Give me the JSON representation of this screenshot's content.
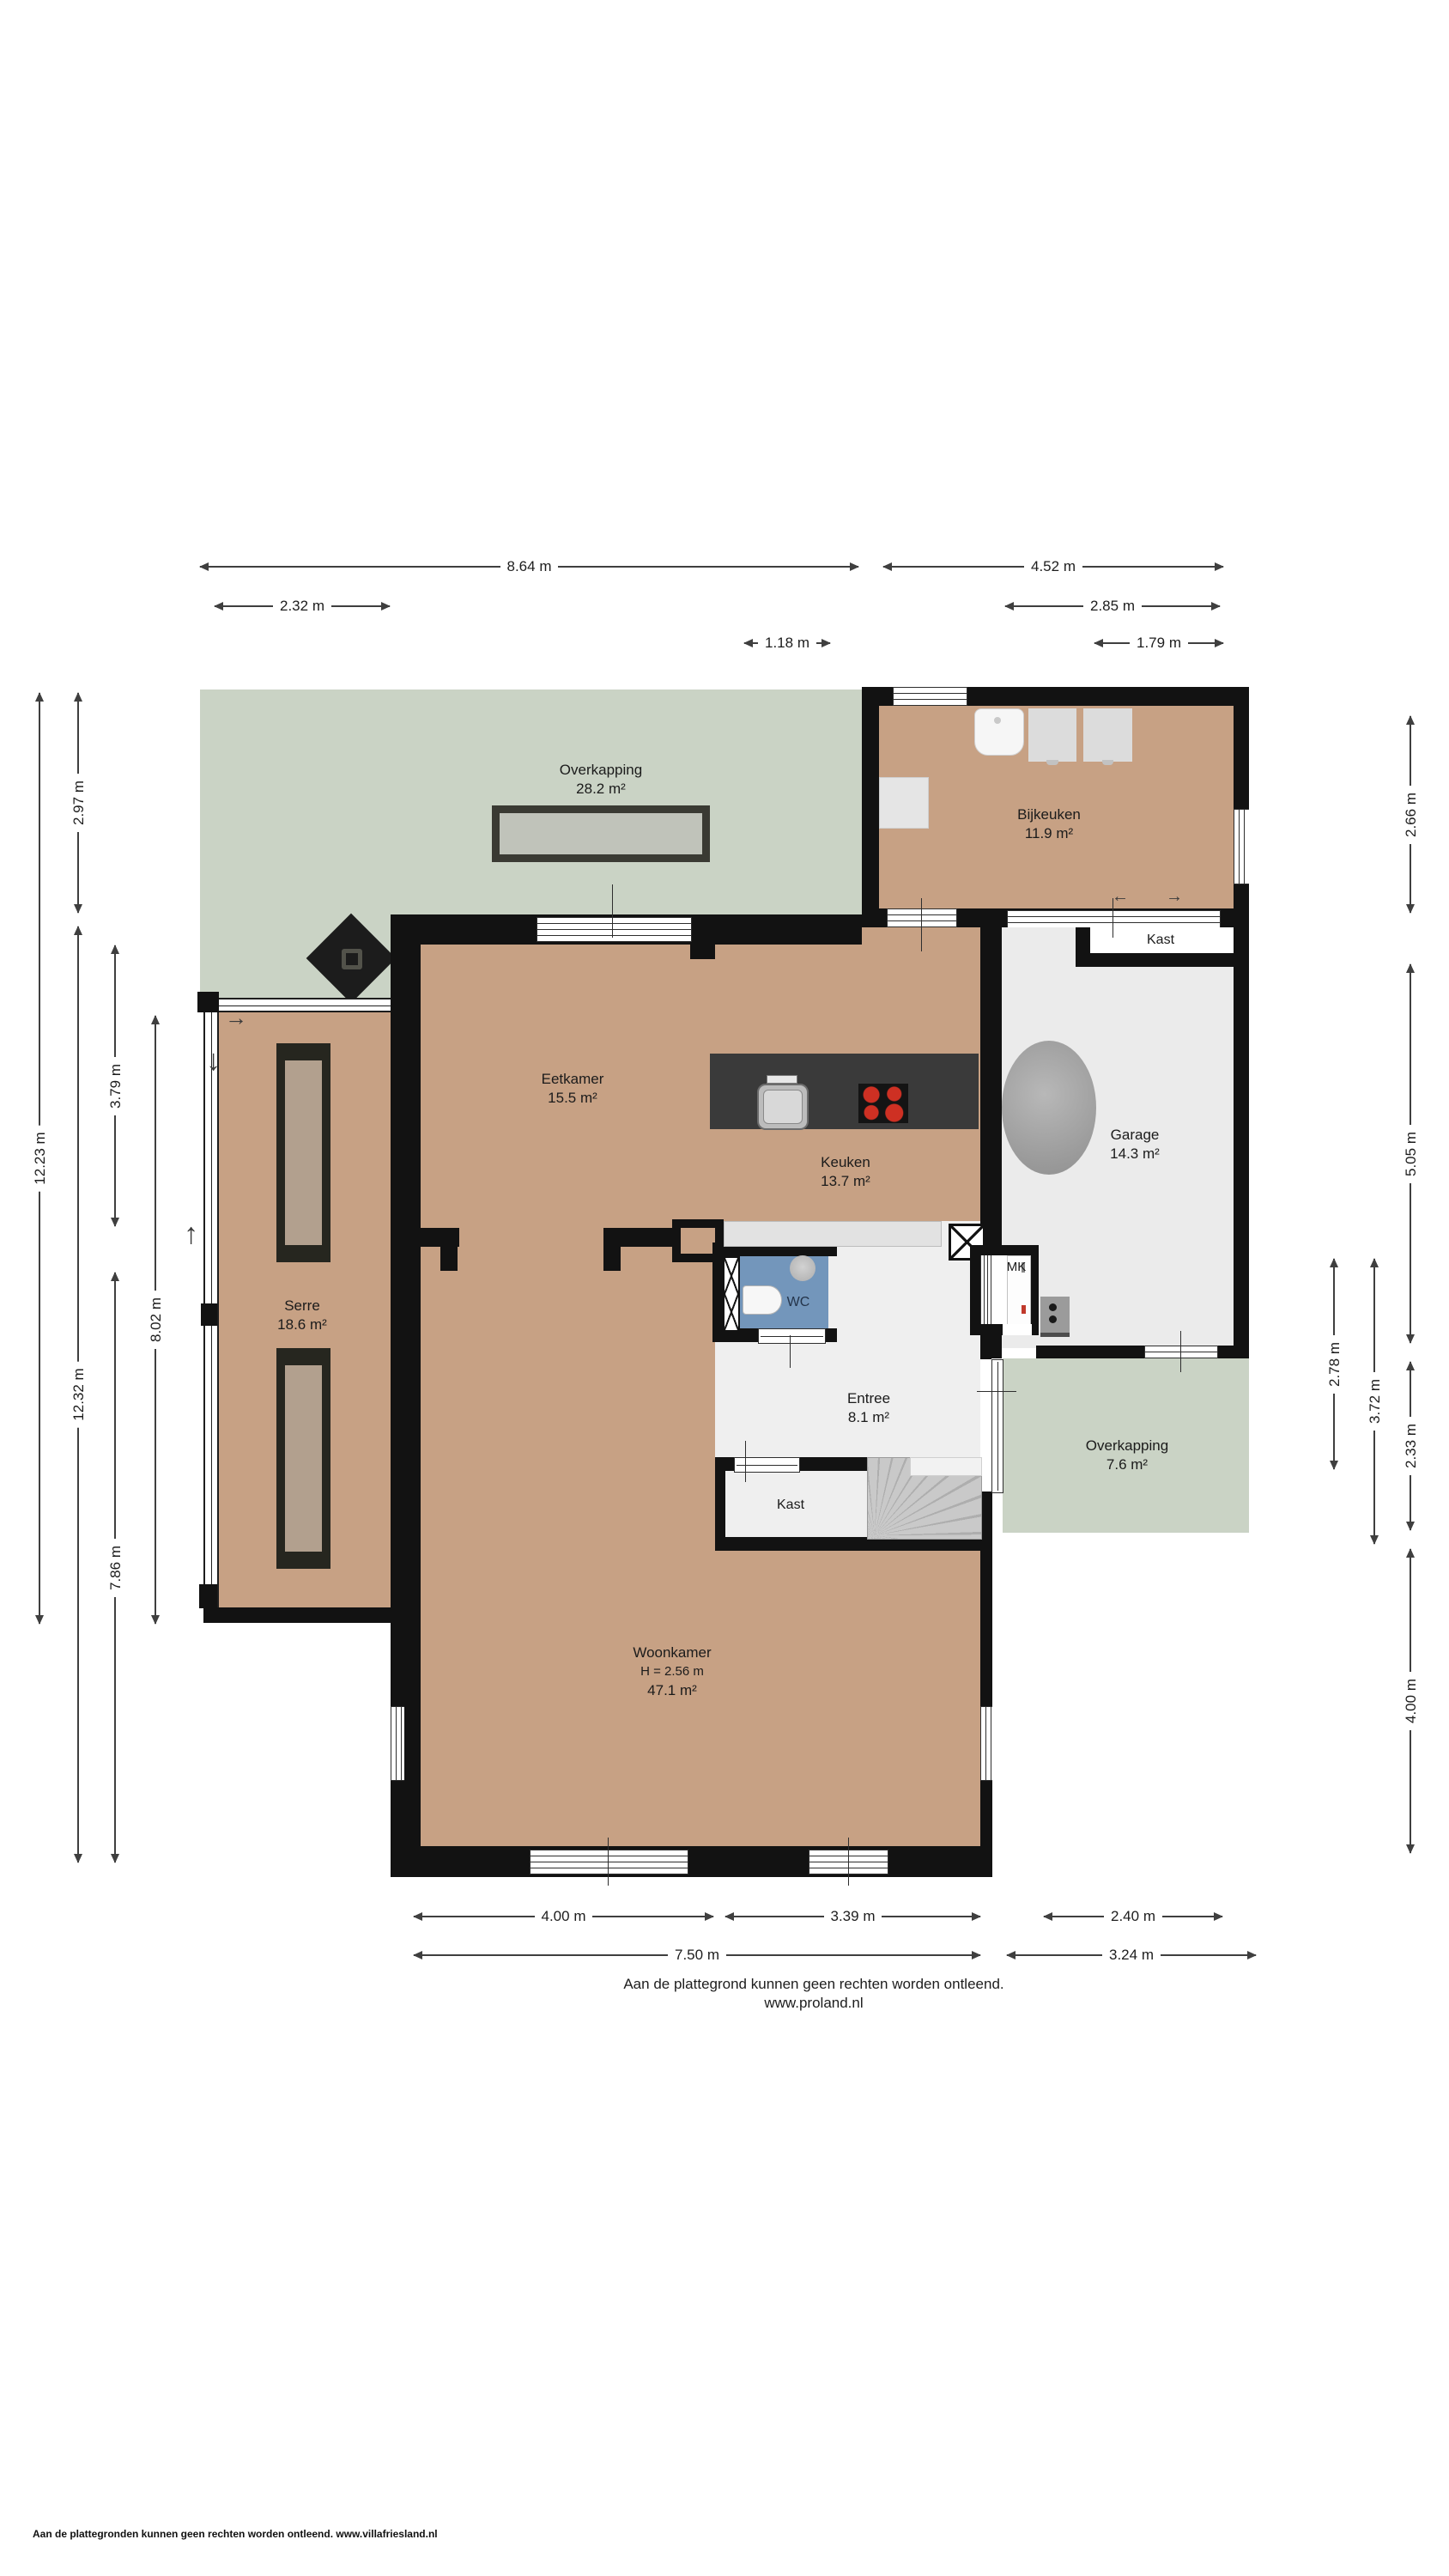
{
  "rooms": {
    "overkapping_top": {
      "name": "Overkapping",
      "area": "28.2 m²"
    },
    "bijkeuken": {
      "name": "Bijkeuken",
      "area": "11.9 m²"
    },
    "kast_top": {
      "name": "Kast"
    },
    "garage": {
      "name": "Garage",
      "area": "14.3 m²"
    },
    "eetkamer": {
      "name": "Eetkamer",
      "area": "15.5 m²"
    },
    "keuken": {
      "name": "Keuken",
      "area": "13.7 m²"
    },
    "serre": {
      "name": "Serre",
      "area": "18.6 m²"
    },
    "wc": {
      "name": "WC"
    },
    "mk": {
      "name": "MK"
    },
    "entree": {
      "name": "Entree",
      "area": "8.1 m²"
    },
    "kast_bottom": {
      "name": "Kast"
    },
    "woonkamer": {
      "name": "Woonkamer",
      "ceiling_height": "H = 2.56 m",
      "area": "47.1 m²"
    },
    "overkapping_right": {
      "name": "Overkapping",
      "area": "7.6 m²"
    }
  },
  "dimensions": {
    "top": [
      {
        "label": "8.64 m"
      },
      {
        "label": "4.52 m"
      },
      {
        "label": "2.32 m"
      },
      {
        "label": "2.85 m"
      },
      {
        "label": "1.18 m"
      },
      {
        "label": "1.79 m"
      }
    ],
    "left": [
      {
        "label": "12.23 m"
      },
      {
        "label": "2.97 m"
      },
      {
        "label": "12.32 m"
      },
      {
        "label": "3.79 m"
      },
      {
        "label": "7.86 m"
      },
      {
        "label": "8.02 m"
      }
    ],
    "right": [
      {
        "label": "2.66 m"
      },
      {
        "label": "5.05 m"
      },
      {
        "label": "2.33 m"
      },
      {
        "label": "4.00 m"
      },
      {
        "label": "3.72 m"
      },
      {
        "label": "2.78 m"
      }
    ],
    "bottom": [
      {
        "label": "4.00 m"
      },
      {
        "label": "3.39 m"
      },
      {
        "label": "2.40 m"
      },
      {
        "label": "7.50 m"
      },
      {
        "label": "3.24 m"
      }
    ]
  },
  "icons": {
    "slide_arrow_left": "←",
    "slide_arrow_right": "→",
    "door_arrow_right": "→",
    "door_arrow_down": "↓",
    "door_arrow_up": "↑"
  },
  "disclaimer": {
    "line1": "Aan de plattegrond kunnen geen rechten worden ontleend.",
    "line2": "www.proland.nl"
  },
  "footer_left": "Aan de plattegronden kunnen geen rechten worden ontleend. www.villafriesland.nl",
  "colors": {
    "wall": "#121212",
    "indoor_floor": "#c7a184",
    "outdoor_floor": "#cad3c5",
    "utility_floor": "#ebebeb",
    "wc_floor": "#7396bb",
    "kitchen_island": "#3a3a3a",
    "cooktop_burner": "#ce3023"
  }
}
